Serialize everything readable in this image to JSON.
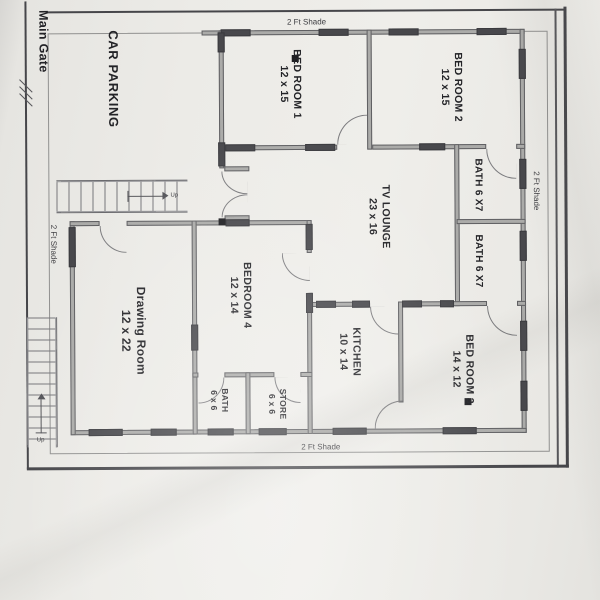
{
  "plan": {
    "outside_labels": {
      "main_gate": "Main Gate",
      "shade_top": "2 Ft Shade",
      "shade_right": "2 Ft Shade",
      "shade_bottom": "2 Ft Shade",
      "shade_left": "2 Ft Shade"
    },
    "rooms": [
      {
        "id": "car-parking",
        "name": "CAR PARKING",
        "size": ""
      },
      {
        "id": "bed-room-1",
        "name": "BED ROOM 1",
        "size": "12 x 15"
      },
      {
        "id": "bed-room-2",
        "name": "BED ROOM 2",
        "size": "12 x 15"
      },
      {
        "id": "bath-upper",
        "name": "BATH 6 X7",
        "size": ""
      },
      {
        "id": "bath-lower",
        "name": "BATH 6 X7",
        "size": ""
      },
      {
        "id": "tv-lounge",
        "name": "TV LOUNGE",
        "size": "23 x 16"
      },
      {
        "id": "bedroom-4",
        "name": "BEDROOM 4",
        "size": "12 x 14"
      },
      {
        "id": "drawing-room",
        "name": "Drawing Room",
        "size": "12 x 22"
      },
      {
        "id": "kitchen",
        "name": "KITCHEN",
        "size": "10 x 14"
      },
      {
        "id": "bed-room-3",
        "name": "BED ROOM 3",
        "size": "14 x 12"
      },
      {
        "id": "bath-small",
        "name": "BATH",
        "size": "6 x 6"
      },
      {
        "id": "store",
        "name": "STORE",
        "size": "6 x 6"
      }
    ],
    "stairs": {
      "upper_label": "Up",
      "outer_label": "Up"
    },
    "colors": {
      "paper": "#eceBe7",
      "ink": "#232327",
      "wall_fill": "#ababa9",
      "wall_edge": "#5f5f62"
    }
  }
}
